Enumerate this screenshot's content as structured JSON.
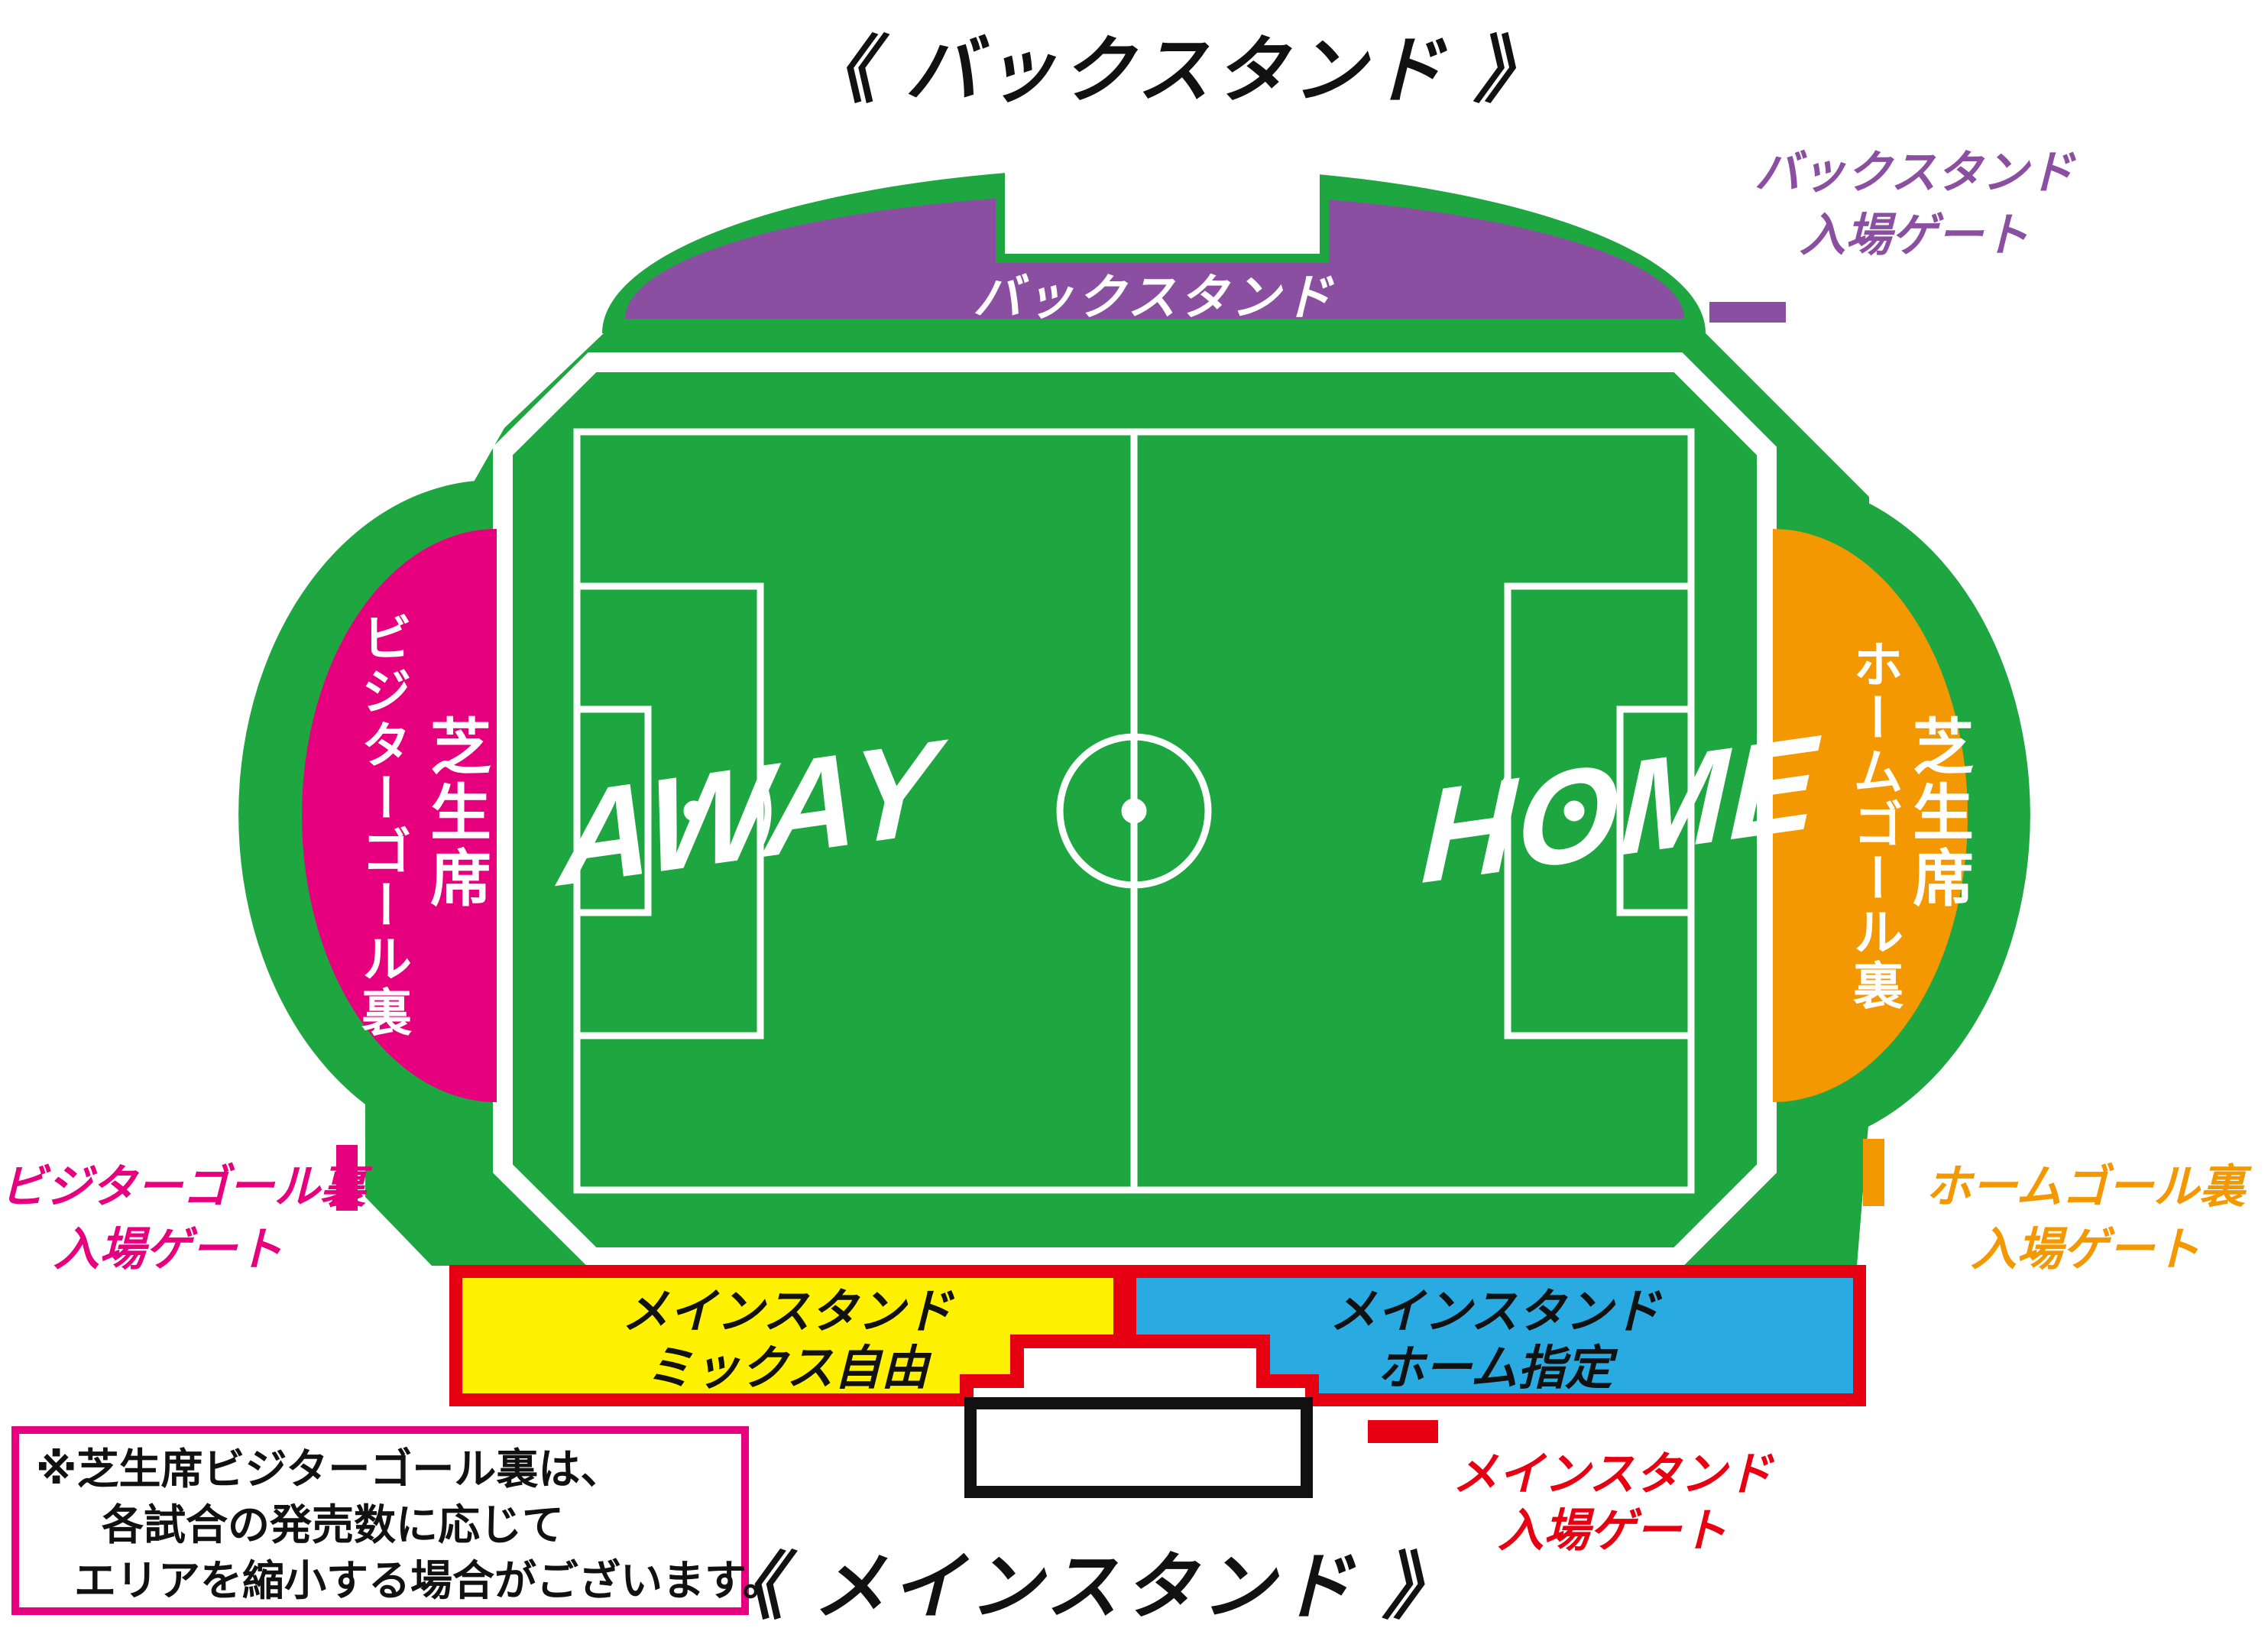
{
  "titles": {
    "back": "《 バックスタンド 》",
    "main": "《 メインスタンド 》"
  },
  "pitch": {
    "away": "AWAY",
    "home": "HOME"
  },
  "sections": {
    "back_stand": {
      "label": "バックスタンド"
    },
    "visitor_lawn": {
      "label_primary": "芝生席",
      "label_secondary": "ビジターゴール裏"
    },
    "home_lawn": {
      "label_primary": "芝生席",
      "label_secondary": "ホームゴール裏"
    },
    "main_mix": {
      "line1": "メインスタンド",
      "line2": "ミックス自由"
    },
    "main_home": {
      "line1": "メインスタンド",
      "line2": "ホーム指定"
    }
  },
  "gates": {
    "back": {
      "line1": "バックスタンド",
      "line2": "入場ゲート"
    },
    "visitor": {
      "line1": "ビジターゴール裏",
      "line2": "入場ゲート"
    },
    "home": {
      "line1": "ホームゴール裏",
      "line2": "入場ゲート"
    },
    "main": {
      "line1": "メインスタンド",
      "line2": "入場ゲート"
    }
  },
  "note": {
    "line1": "※芝生席ビジターゴール裏は、",
    "line2": "各試合の発売数に応じて",
    "line3": "エリアを縮小する場合がございます。"
  },
  "colors": {
    "green": "#1EA641",
    "purple": "#8A4FA0",
    "pink": "#E6007E",
    "orange": "#F39800",
    "yellow": "#FFF100",
    "blue": "#29ABE2",
    "red": "#E60012",
    "white": "#FFFFFF",
    "black": "#111111"
  }
}
